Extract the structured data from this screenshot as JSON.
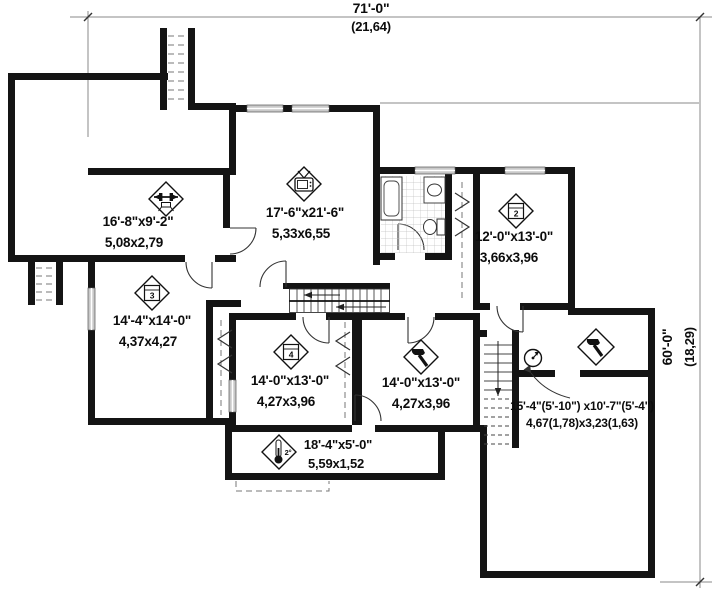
{
  "dims": {
    "w": "71'-0\"",
    "wm": "(21,64)",
    "h": "60'-0\"",
    "hm": "(18,29)"
  },
  "rooms": [
    {
      "id": "exercise-room",
      "imperial": "16'-8\"x9'-2\"",
      "metric": "5,08x2,79",
      "icon": "exercise-icon"
    },
    {
      "id": "family-room",
      "imperial": "17'-6\"x21'-6\"",
      "metric": "5,33x6,55",
      "icon": "tv-icon"
    },
    {
      "id": "bedroom-2",
      "imperial": "12'-0\"x13'-0\"",
      "metric": "3,66x3,96",
      "icon": "bed-icon",
      "badge": "2"
    },
    {
      "id": "bedroom-3",
      "imperial": "14'-4\"x14'-0\"",
      "metric": "4,37x4,27",
      "icon": "bed-icon",
      "badge": "3"
    },
    {
      "id": "bedroom-4",
      "imperial": "14'-0\"x13'-0\"",
      "metric": "4,27x3,96",
      "icon": "bed-icon",
      "badge": "4"
    },
    {
      "id": "workshop",
      "imperial": "14'-0\"x13'-0\"",
      "metric": "4,27x3,96",
      "icon": "hammer-icon"
    },
    {
      "id": "cold-room",
      "imperial": "18'-4\"x5'-0\"",
      "metric": "5,59x1,52",
      "icon": "thermometer-icon",
      "badge": "2°"
    },
    {
      "id": "storage-mechanical",
      "imperial": "15'-4\"(5'-10\") x10'-7\"(5'-4\")",
      "metric": "4,67(1,78)x3,23(1,63)",
      "icon": "hammer-icon"
    }
  ],
  "colors": {
    "wall": "#141414",
    "window": "#c9c9c9",
    "dim_line": "#888",
    "text": "#0c0c0c"
  }
}
